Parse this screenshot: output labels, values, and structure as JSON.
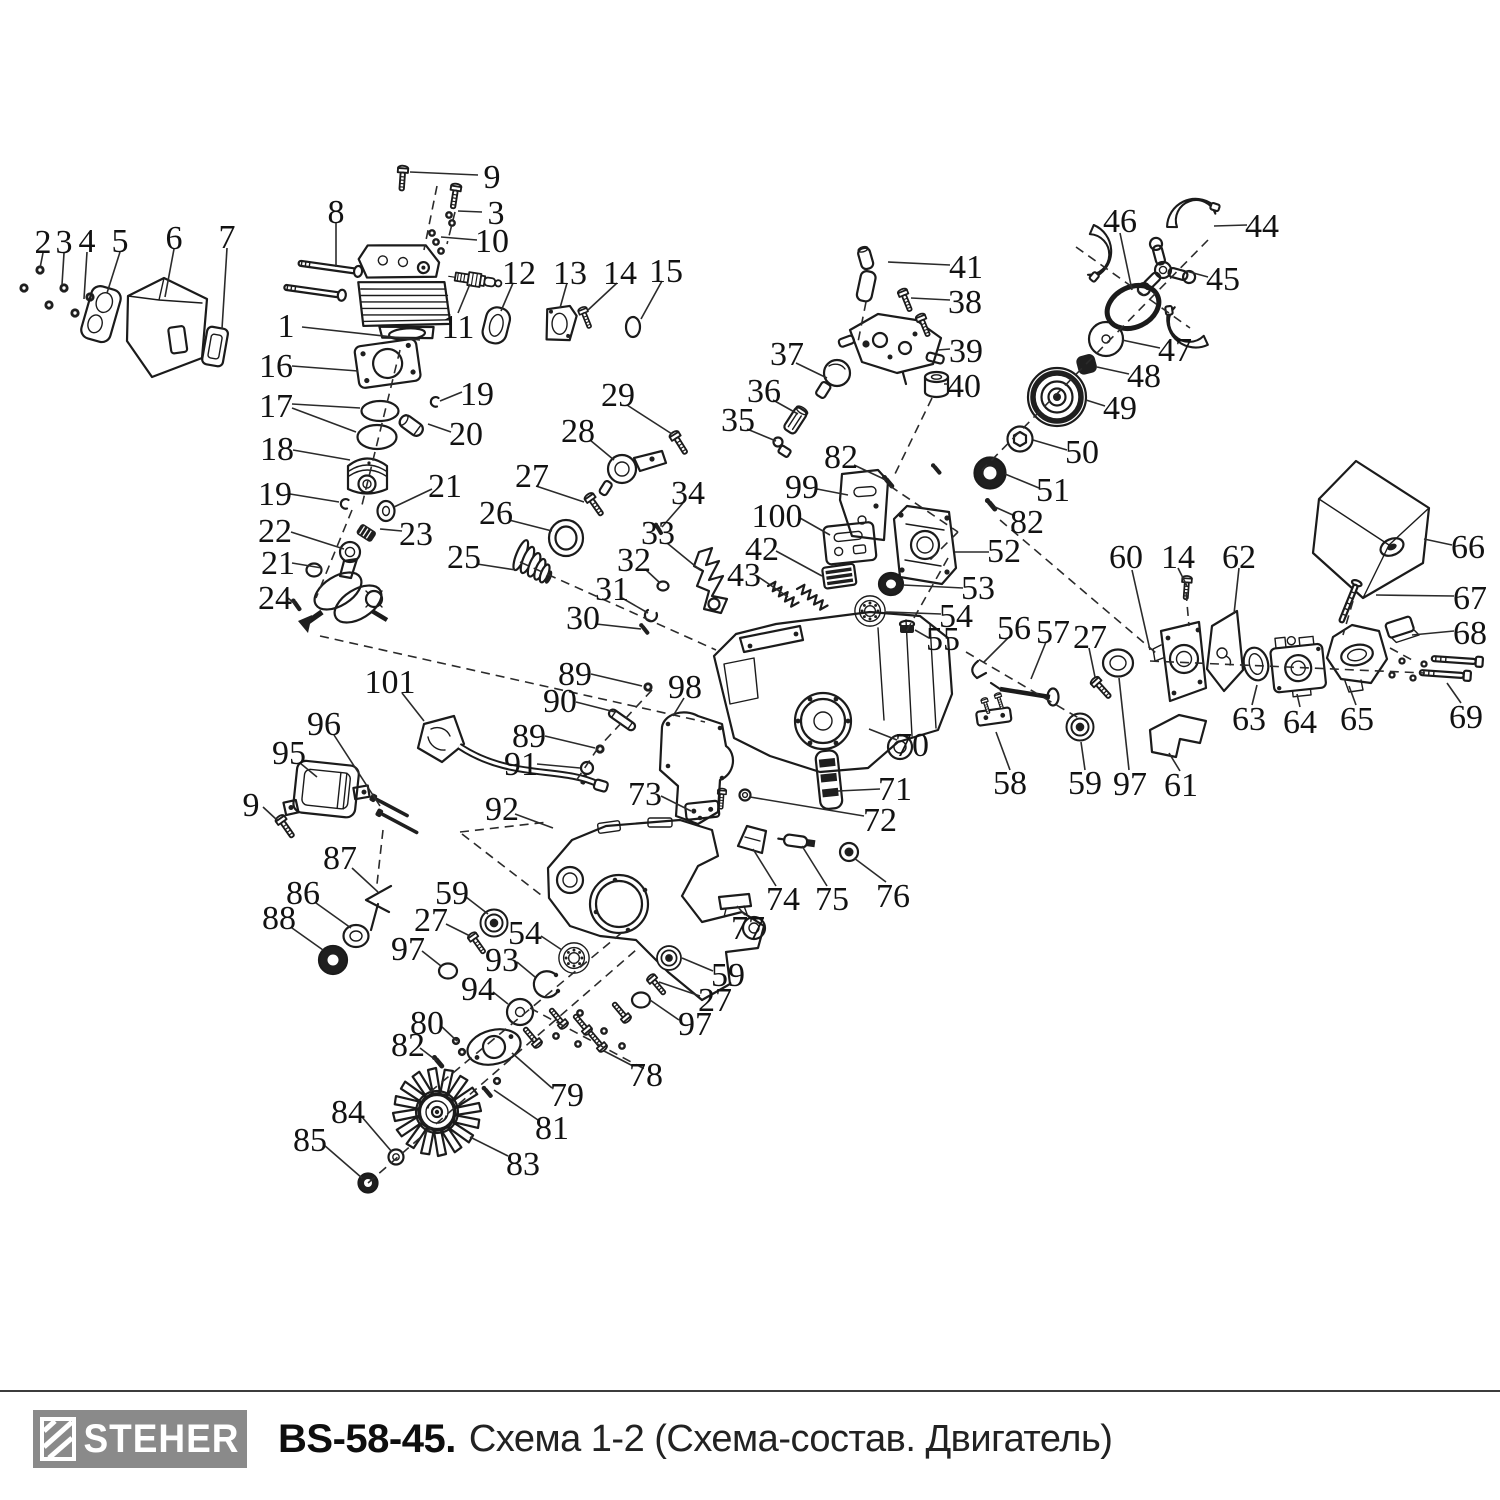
{
  "footer": {
    "brand": "STEHER",
    "model": "BS-58-45.",
    "subtitle": "Схема 1-2 (Схема-состав. Двигатель)"
  },
  "diagram": {
    "ink": "#1b1b1b",
    "logo_bg": "#8a8a8a",
    "labels": [
      [
        "1",
        286,
        325
      ],
      [
        "2",
        43,
        241
      ],
      [
        "3",
        64,
        241
      ],
      [
        "4",
        87,
        240
      ],
      [
        "5",
        120,
        240
      ],
      [
        "6",
        174,
        237
      ],
      [
        "7",
        227,
        236
      ],
      [
        "8",
        336,
        211
      ],
      [
        "9",
        492,
        176
      ],
      [
        "3",
        496,
        212
      ],
      [
        "10",
        492,
        240
      ],
      [
        "11",
        458,
        326
      ],
      [
        "12",
        519,
        272
      ],
      [
        "13",
        570,
        272
      ],
      [
        "14",
        620,
        272
      ],
      [
        "15",
        666,
        270
      ],
      [
        "16",
        276,
        365
      ],
      [
        "17",
        276,
        405
      ],
      [
        "18",
        277,
        448
      ],
      [
        "19",
        477,
        393
      ],
      [
        "20",
        466,
        433
      ],
      [
        "19",
        275,
        493
      ],
      [
        "21",
        445,
        485
      ],
      [
        "22",
        275,
        530
      ],
      [
        "23",
        416,
        533
      ],
      [
        "21",
        278,
        562
      ],
      [
        "24",
        275,
        597
      ],
      [
        "25",
        464,
        556
      ],
      [
        "26",
        496,
        512
      ],
      [
        "27",
        532,
        475
      ],
      [
        "28",
        578,
        430
      ],
      [
        "29",
        618,
        394
      ],
      [
        "30",
        583,
        617
      ],
      [
        "31",
        612,
        588
      ],
      [
        "32",
        634,
        559
      ],
      [
        "33",
        658,
        532
      ],
      [
        "34",
        688,
        492
      ],
      [
        "35",
        738,
        419
      ],
      [
        "36",
        764,
        390
      ],
      [
        "37",
        787,
        353
      ],
      [
        "38",
        965,
        301
      ],
      [
        "39",
        966,
        350
      ],
      [
        "40",
        964,
        385
      ],
      [
        "41",
        966,
        266
      ],
      [
        "42",
        762,
        548
      ],
      [
        "43",
        744,
        574
      ],
      [
        "44",
        1262,
        225
      ],
      [
        "45",
        1223,
        278
      ],
      [
        "46",
        1120,
        220
      ],
      [
        "47",
        1175,
        349
      ],
      [
        "48",
        1144,
        375
      ],
      [
        "49",
        1120,
        407
      ],
      [
        "50",
        1082,
        451
      ],
      [
        "51",
        1053,
        489
      ],
      [
        "82",
        841,
        456
      ],
      [
        "99",
        802,
        486
      ],
      [
        "100",
        777,
        515
      ],
      [
        "82",
        1027,
        521
      ],
      [
        "52",
        1004,
        550
      ],
      [
        "53",
        978,
        587
      ],
      [
        "54",
        956,
        615
      ],
      [
        "55",
        943,
        638
      ],
      [
        "56",
        1014,
        627
      ],
      [
        "57",
        1053,
        631
      ],
      [
        "27",
        1090,
        636
      ],
      [
        "60",
        1126,
        556
      ],
      [
        "14",
        1178,
        556
      ],
      [
        "62",
        1239,
        556
      ],
      [
        "66",
        1468,
        546
      ],
      [
        "67",
        1470,
        597
      ],
      [
        "68",
        1470,
        632
      ],
      [
        "69",
        1466,
        716
      ],
      [
        "63",
        1249,
        718
      ],
      [
        "64",
        1300,
        721
      ],
      [
        "65",
        1357,
        718
      ],
      [
        "58",
        1010,
        782
      ],
      [
        "59",
        1085,
        782
      ],
      [
        "97",
        1130,
        783
      ],
      [
        "61",
        1181,
        784
      ],
      [
        "89",
        575,
        673
      ],
      [
        "90",
        560,
        700
      ],
      [
        "98",
        685,
        686
      ],
      [
        "89",
        529,
        735
      ],
      [
        "91",
        521,
        763
      ],
      [
        "70",
        912,
        744
      ],
      [
        "71",
        895,
        788
      ],
      [
        "72",
        880,
        819
      ],
      [
        "73",
        645,
        793
      ],
      [
        "74",
        783,
        898
      ],
      [
        "75",
        832,
        898
      ],
      [
        "76",
        893,
        895
      ],
      [
        "77",
        748,
        927
      ],
      [
        "101",
        390,
        681
      ],
      [
        "96",
        324,
        723
      ],
      [
        "95",
        289,
        752
      ],
      [
        "9",
        251,
        804
      ],
      [
        "87",
        340,
        857
      ],
      [
        "86",
        303,
        892
      ],
      [
        "88",
        279,
        917
      ],
      [
        "92",
        502,
        808
      ],
      [
        "59",
        452,
        892
      ],
      [
        "27",
        431,
        919
      ],
      [
        "97",
        408,
        948
      ],
      [
        "54",
        525,
        932
      ],
      [
        "93",
        502,
        959
      ],
      [
        "94",
        478,
        988
      ],
      [
        "80",
        427,
        1022
      ],
      [
        "82",
        408,
        1044
      ],
      [
        "59",
        728,
        974
      ],
      [
        "27",
        715,
        999
      ],
      [
        "97",
        695,
        1023
      ],
      [
        "78",
        646,
        1074
      ],
      [
        "79",
        567,
        1094
      ],
      [
        "81",
        552,
        1127
      ],
      [
        "84",
        348,
        1111
      ],
      [
        "85",
        310,
        1139
      ],
      [
        "83",
        523,
        1163
      ]
    ],
    "leaders": [
      [
        302,
        327,
        420,
        340
      ],
      [
        43,
        253,
        40,
        268
      ],
      [
        64,
        253,
        62,
        285
      ],
      [
        87,
        252,
        84,
        299
      ],
      [
        120,
        252,
        107,
        293
      ],
      [
        174,
        249,
        165,
        297
      ],
      [
        227,
        248,
        222,
        329
      ],
      [
        336,
        222,
        336,
        267
      ],
      [
        478,
        175,
        410,
        172
      ],
      [
        482,
        212,
        458,
        211
      ],
      [
        477,
        240,
        441,
        237
      ],
      [
        458,
        313,
        470,
        284
      ],
      [
        513,
        283,
        501,
        311
      ],
      [
        567,
        283,
        560,
        308
      ],
      [
        617,
        283,
        588,
        310
      ],
      [
        662,
        281,
        641,
        319
      ],
      [
        292,
        366,
        358,
        371
      ],
      [
        292,
        404,
        360,
        408
      ],
      [
        292,
        408,
        356,
        432
      ],
      [
        293,
        450,
        350,
        460
      ],
      [
        462,
        392,
        440,
        401
      ],
      [
        451,
        432,
        428,
        424
      ],
      [
        290,
        494,
        339,
        502
      ],
      [
        432,
        489,
        394,
        507
      ],
      [
        291,
        532,
        344,
        549
      ],
      [
        402,
        531,
        380,
        529
      ],
      [
        292,
        563,
        322,
        568
      ],
      [
        288,
        598,
        295,
        604
      ],
      [
        477,
        564,
        516,
        570
      ],
      [
        509,
        520,
        552,
        531
      ],
      [
        536,
        486,
        584,
        502
      ],
      [
        590,
        440,
        614,
        460
      ],
      [
        627,
        405,
        672,
        434
      ],
      [
        596,
        624,
        641,
        629
      ],
      [
        622,
        598,
        648,
        613
      ],
      [
        645,
        569,
        660,
        583
      ],
      [
        667,
        543,
        700,
        570
      ],
      [
        683,
        503,
        662,
        527
      ],
      [
        747,
        429,
        776,
        441
      ],
      [
        773,
        400,
        798,
        414
      ],
      [
        796,
        363,
        827,
        378
      ],
      [
        950,
        300,
        911,
        298
      ],
      [
        950,
        349,
        938,
        350
      ],
      [
        948,
        384,
        944,
        384
      ],
      [
        950,
        265,
        888,
        262
      ],
      [
        776,
        551,
        822,
        576
      ],
      [
        757,
        576,
        788,
        597
      ],
      [
        1247,
        225,
        1214,
        226
      ],
      [
        1208,
        277,
        1186,
        271
      ],
      [
        1120,
        233,
        1132,
        290
      ],
      [
        1160,
        348,
        1122,
        340
      ],
      [
        1129,
        374,
        1097,
        367
      ],
      [
        1105,
        406,
        1086,
        400
      ],
      [
        1067,
        450,
        1033,
        440
      ],
      [
        1039,
        488,
        1005,
        474
      ],
      [
        854,
        465,
        886,
        480
      ],
      [
        817,
        489,
        848,
        495
      ],
      [
        800,
        518,
        830,
        535
      ],
      [
        1015,
        516,
        995,
        507
      ],
      [
        989,
        552,
        955,
        552
      ],
      [
        963,
        588,
        903,
        585
      ],
      [
        941,
        614,
        886,
        612
      ],
      [
        929,
        638,
        915,
        630
      ],
      [
        1008,
        638,
        984,
        662
      ],
      [
        1046,
        642,
        1031,
        679
      ],
      [
        1089,
        648,
        1095,
        677
      ],
      [
        1132,
        570,
        1150,
        650
      ],
      [
        1178,
        568,
        1187,
        586
      ],
      [
        1239,
        568,
        1234,
        614
      ],
      [
        1452,
        545,
        1424,
        539
      ],
      [
        1454,
        596,
        1376,
        595
      ],
      [
        1454,
        631,
        1412,
        635
      ],
      [
        1461,
        703,
        1447,
        683
      ],
      [
        1252,
        705,
        1257,
        685
      ],
      [
        1300,
        707,
        1297,
        694
      ],
      [
        1356,
        705,
        1349,
        686
      ],
      [
        1010,
        770,
        996,
        732
      ],
      [
        1085,
        770,
        1081,
        742
      ],
      [
        1129,
        770,
        1119,
        678
      ],
      [
        1180,
        771,
        1169,
        753
      ],
      [
        591,
        674,
        642,
        686
      ],
      [
        576,
        702,
        615,
        712
      ],
      [
        684,
        698,
        673,
        716
      ],
      [
        545,
        736,
        595,
        748
      ],
      [
        537,
        764,
        580,
        768
      ],
      [
        897,
        740,
        869,
        729
      ],
      [
        880,
        789,
        838,
        791
      ],
      [
        864,
        816,
        750,
        797
      ],
      [
        661,
        796,
        691,
        811
      ],
      [
        776,
        886,
        753,
        849
      ],
      [
        827,
        886,
        802,
        846
      ],
      [
        886,
        882,
        854,
        858
      ],
      [
        745,
        915,
        737,
        906
      ],
      [
        402,
        693,
        424,
        721
      ],
      [
        334,
        735,
        380,
        806
      ],
      [
        300,
        763,
        317,
        777
      ],
      [
        263,
        807,
        277,
        820
      ],
      [
        352,
        868,
        378,
        892
      ],
      [
        316,
        903,
        351,
        928
      ],
      [
        292,
        928,
        323,
        950
      ],
      [
        515,
        814,
        553,
        828
      ],
      [
        466,
        897,
        488,
        914
      ],
      [
        446,
        924,
        470,
        936
      ],
      [
        422,
        951,
        441,
        966
      ],
      [
        541,
        936,
        562,
        950
      ],
      [
        517,
        962,
        535,
        977
      ],
      [
        493,
        992,
        508,
        1004
      ],
      [
        441,
        1026,
        457,
        1041
      ],
      [
        420,
        1048,
        437,
        1061
      ],
      [
        713,
        971,
        682,
        958
      ],
      [
        700,
        996,
        659,
        982
      ],
      [
        679,
        1020,
        650,
        1000
      ],
      [
        633,
        1066,
        604,
        1051
      ],
      [
        552,
        1088,
        512,
        1053
      ],
      [
        538,
        1120,
        494,
        1090
      ],
      [
        362,
        1117,
        392,
        1152
      ],
      [
        324,
        1145,
        362,
        1178
      ],
      [
        508,
        1156,
        470,
        1137
      ]
    ],
    "dashes": [
      [
        437,
        186,
        424,
        250
      ],
      [
        455,
        212,
        447,
        244
      ],
      [
        400,
        350,
        362,
        505
      ],
      [
        352,
        510,
        316,
        598
      ],
      [
        320,
        636,
        705,
        722
      ],
      [
        520,
        562,
        716,
        650
      ],
      [
        1208,
        240,
        982,
        470
      ],
      [
        1076,
        247,
        1190,
        328
      ],
      [
        932,
        398,
        893,
        478
      ],
      [
        890,
        486,
        958,
        532
      ],
      [
        958,
        532,
        928,
        562
      ],
      [
        948,
        558,
        906,
        632
      ],
      [
        1000,
        520,
        1156,
        653
      ],
      [
        1150,
        661,
        1425,
        673
      ],
      [
        1186,
        592,
        1189,
        626
      ],
      [
        1353,
        601,
        1343,
        635
      ],
      [
        1390,
        648,
        1414,
        661
      ],
      [
        966,
        652,
        1082,
        720
      ],
      [
        368,
        1183,
        636,
        950
      ],
      [
        530,
        1008,
        650,
        1072
      ],
      [
        430,
        1092,
        625,
        930
      ],
      [
        383,
        830,
        377,
        884
      ],
      [
        460,
        832,
        548,
        822
      ],
      [
        462,
        834,
        545,
        898
      ],
      [
        652,
        690,
        598,
        748
      ],
      [
        598,
        748,
        574,
        784
      ],
      [
        866,
        302,
        858,
        342
      ]
    ]
  }
}
